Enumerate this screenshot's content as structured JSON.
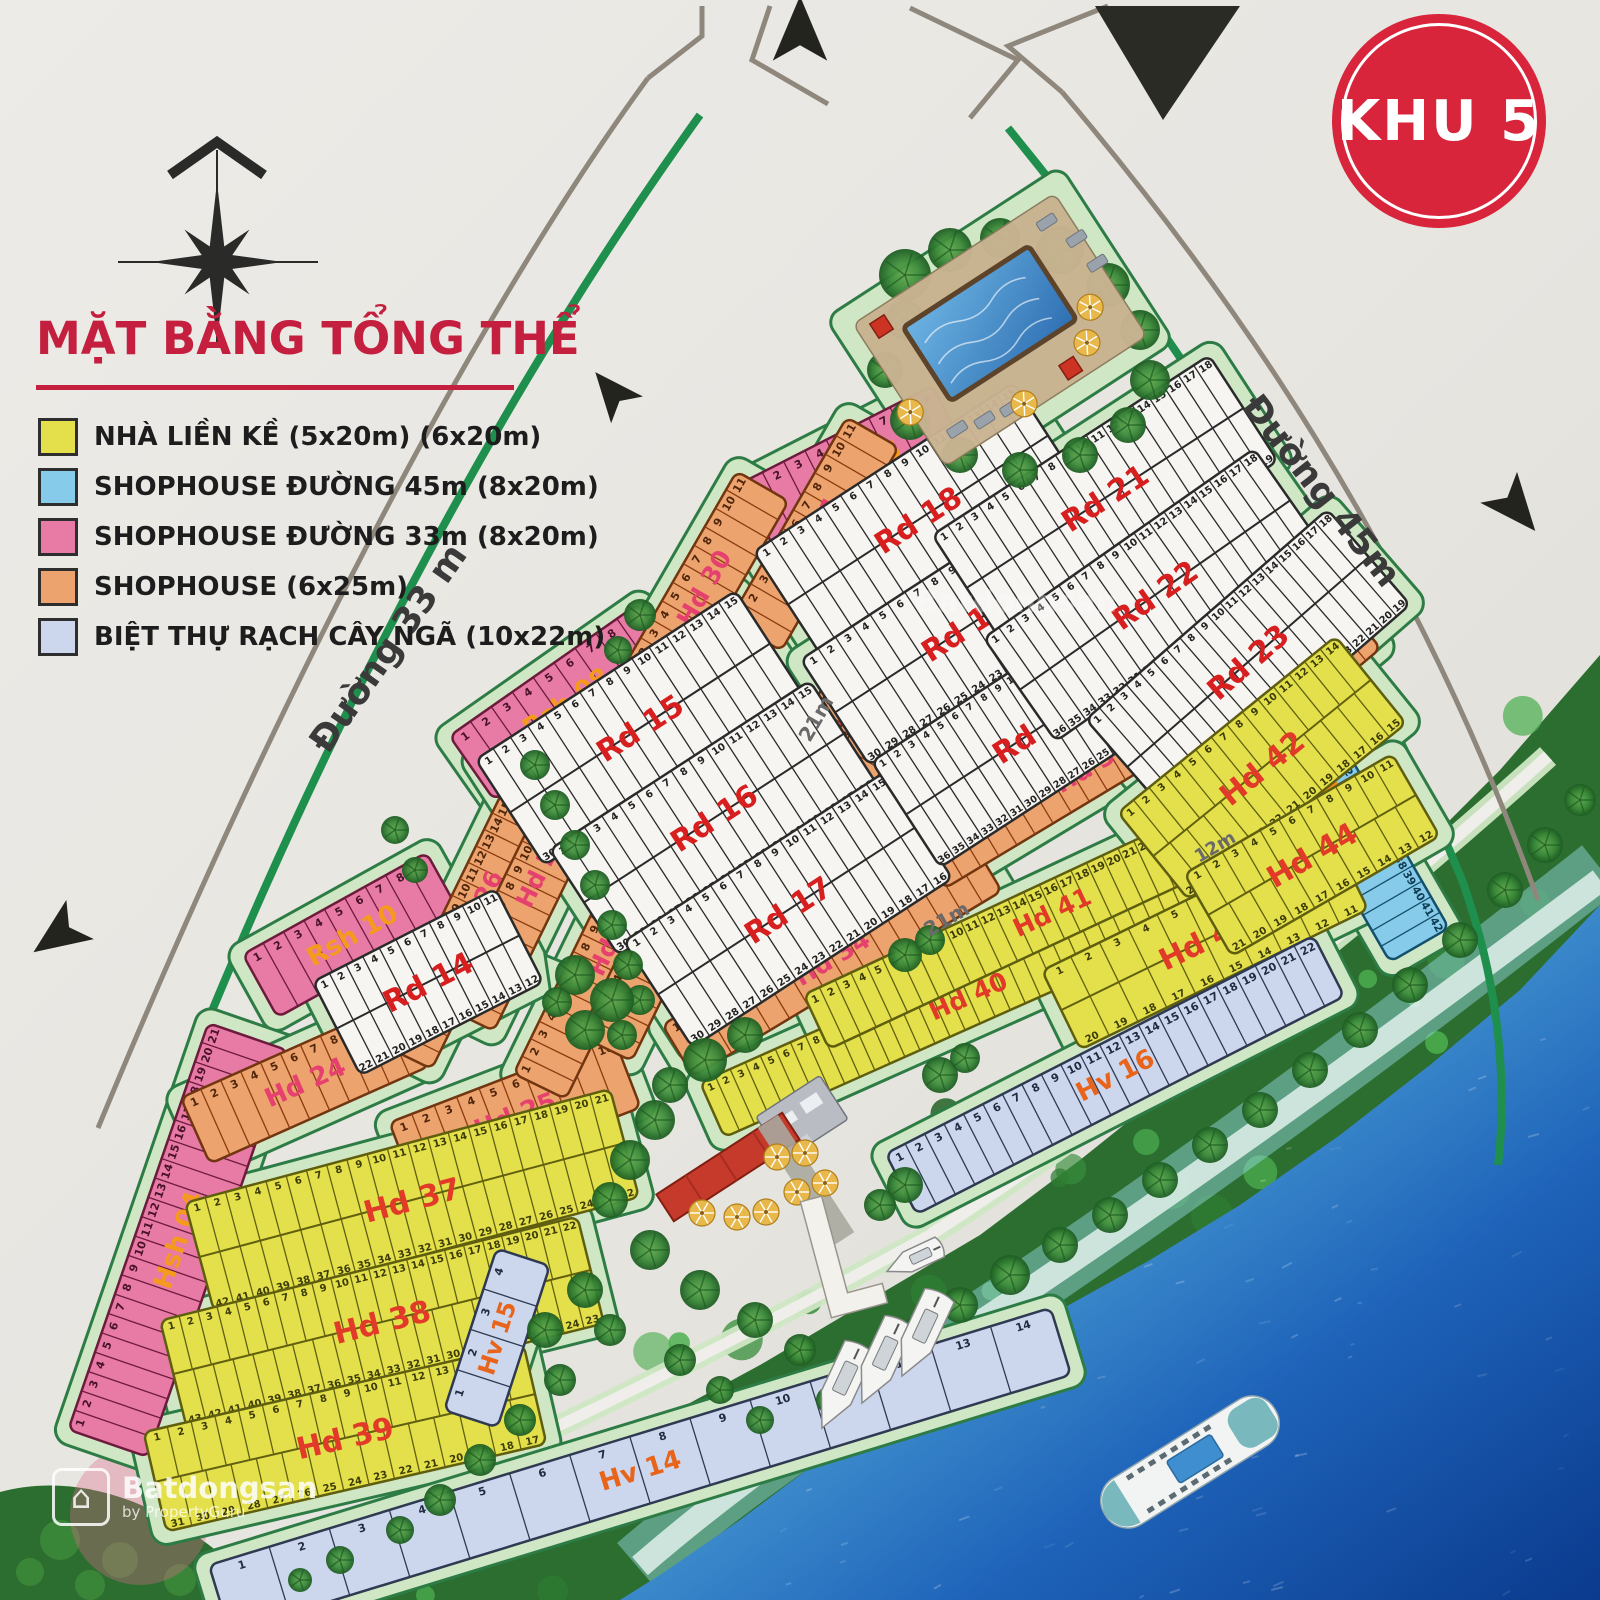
{
  "badge": {
    "text": "KHU 5",
    "bg": "#d8253c",
    "fg": "#ffffff"
  },
  "legend": {
    "title": "MẶT BẰNG TỔNG THỂ",
    "title_color": "#c41f3e",
    "items": [
      {
        "label": "NHÀ LIỀN KỀ (5x20m) (6x20m)",
        "color": "#e3e04b"
      },
      {
        "label": "SHOPHOUSE  ĐƯỜNG 45m (8x20m)",
        "color": "#86cbe9"
      },
      {
        "label": "SHOPHOUSE  ĐƯỜNG 33m (8x20m)",
        "color": "#e77ba6"
      },
      {
        "label": "SHOPHOUSE (6x25m)",
        "color": "#eca36e"
      },
      {
        "label": "BIỆT THỰ RẠCH CÂY NGÃ (10x22m)",
        "color": "#ccd7ee"
      }
    ]
  },
  "watermark": {
    "line1": "Batdongsan",
    "line2": "by PropertyGuru",
    "brand": "Batdongsan"
  },
  "road_labels": [
    {
      "text": "Đường 33 m",
      "x": 398,
      "y": 655,
      "rot": -55,
      "size": 36,
      "color": "#3a3a3a"
    },
    {
      "text": "Đường 45m",
      "x": 1312,
      "y": 498,
      "rot": 52,
      "size": 36,
      "color": "#3a3a3a"
    },
    {
      "text": "21m",
      "x": 822,
      "y": 722,
      "rot": -60,
      "size": 20,
      "color": "#6a6a6a"
    },
    {
      "text": "21m",
      "x": 950,
      "y": 925,
      "rot": -30,
      "size": 20,
      "color": "#6a6a6a"
    },
    {
      "text": "12m",
      "x": 1218,
      "y": 852,
      "rot": -30,
      "size": 18,
      "color": "#6a6a6a"
    }
  ],
  "block_label_colors": {
    "pink": "#f59a1d",
    "orange": "#e5406e",
    "yellow": "#e23a28",
    "blue": "#f08a1d",
    "villa": "#e8641a",
    "white": "#d81f1f"
  },
  "blocks": [
    {
      "label": "Rsh 06",
      "type": "pink",
      "x": 855,
      "y": 470,
      "w": 215,
      "h": 80,
      "a": -27,
      "rows": 1,
      "from": 1,
      "to": 9
    },
    {
      "label": "Rsh 08",
      "type": "pink",
      "x": 566,
      "y": 702,
      "w": 230,
      "h": 78,
      "a": -35,
      "rows": 1,
      "from": 1,
      "to": 9
    },
    {
      "label": "Rsh 10",
      "type": "pink",
      "x": 352,
      "y": 935,
      "w": 210,
      "h": 72,
      "a": -29,
      "rows": 1,
      "from": 1,
      "to": 9
    },
    {
      "label": "Hsh 04",
      "type": "pink",
      "x": 178,
      "y": 1240,
      "w": 430,
      "h": 84,
      "a": -71,
      "rows": 1,
      "from": 1,
      "to": 21
    },
    {
      "label": "Rsh 16",
      "type": "blue",
      "x": 1252,
      "y": 565,
      "w": 350,
      "h": 78,
      "a": 63,
      "rows": 1,
      "from": 1,
      "to": 16
    },
    {
      "label": "Hsh 05",
      "type": "blue",
      "x": 1352,
      "y": 828,
      "w": 270,
      "h": 68,
      "a": 60,
      "rows": 1,
      "from": 28,
      "to": 42
    },
    {
      "label": "Hd 24",
      "type": "orange",
      "x": 305,
      "y": 1082,
      "w": 240,
      "h": 72,
      "a": -24,
      "rows": 1,
      "from": 1,
      "to": 11
    },
    {
      "label": "Hd 25",
      "type": "orange",
      "x": 515,
      "y": 1115,
      "w": 240,
      "h": 76,
      "a": -21,
      "rows": 1,
      "from": 1,
      "to": 10
    },
    {
      "label": "Hd 26",
      "type": "orange",
      "x": 478,
      "y": 908,
      "w": 330,
      "h": 58,
      "a": -64,
      "rows": 1,
      "from": 1,
      "to": 18
    },
    {
      "label": "Hd 27",
      "type": "orange",
      "x": 540,
      "y": 870,
      "w": 330,
      "h": 58,
      "a": -64,
      "rows": 1,
      "from": 1,
      "to": 18
    },
    {
      "label": "Hd 28",
      "type": "orange",
      "x": 612,
      "y": 938,
      "w": 330,
      "h": 58,
      "a": -64,
      "rows": 1,
      "from": 1,
      "to": 17
    },
    {
      "label": "Hd 29",
      "type": "orange",
      "x": 678,
      "y": 900,
      "w": 330,
      "h": 58,
      "a": -64,
      "rows": 1,
      "from": 1,
      "to": 17
    },
    {
      "label": "Hd 30",
      "type": "orange",
      "x": 704,
      "y": 588,
      "w": 235,
      "h": 60,
      "a": -60,
      "rows": 1,
      "from": 1,
      "to": 11
    },
    {
      "label": "Hd 31",
      "type": "orange",
      "x": 814,
      "y": 534,
      "w": 235,
      "h": 60,
      "a": -60,
      "rows": 1,
      "from": 1,
      "to": 11
    },
    {
      "label": "Hd 32",
      "type": "orange",
      "x": 848,
      "y": 702,
      "w": 300,
      "h": 58,
      "a": -58,
      "rows": 1,
      "from": 1,
      "to": 14
    },
    {
      "label": "Hd 33",
      "type": "orange",
      "x": 914,
      "y": 664,
      "w": 300,
      "h": 58,
      "a": -58,
      "rows": 1,
      "from": 1,
      "to": 14
    },
    {
      "label": "Hd 34",
      "type": "orange",
      "x": 832,
      "y": 958,
      "w": 360,
      "h": 60,
      "a": -31,
      "rows": 1,
      "from": 1,
      "to": 16
    },
    {
      "label": "Hd 35",
      "type": "orange",
      "x": 1092,
      "y": 765,
      "w": 380,
      "h": 60,
      "a": -31,
      "rows": 1,
      "from": 1,
      "to": 18
    },
    {
      "label": "Hd 36",
      "type": "orange",
      "x": 1258,
      "y": 712,
      "w": 270,
      "h": 60,
      "a": -40,
      "rows": 1,
      "from": 1,
      "to": 14
    },
    {
      "label": "Rd 14",
      "type": "white",
      "x": 428,
      "y": 982,
      "w": 205,
      "h": 105,
      "a": -27,
      "rows": 2,
      "from": 1,
      "to": 22
    },
    {
      "label": "Rd 15",
      "type": "white",
      "x": 640,
      "y": 728,
      "w": 310,
      "h": 126,
      "a": -33,
      "rows": 2,
      "from": 1,
      "to": 30
    },
    {
      "label": "Rd 16",
      "type": "white",
      "x": 714,
      "y": 818,
      "w": 310,
      "h": 126,
      "a": -33,
      "rows": 2,
      "from": 1,
      "to": 30
    },
    {
      "label": "Rd 17",
      "type": "white",
      "x": 788,
      "y": 910,
      "w": 310,
      "h": 126,
      "a": -33,
      "rows": 2,
      "from": 1,
      "to": 30
    },
    {
      "label": "Rd 18",
      "type": "white",
      "x": 918,
      "y": 520,
      "w": 310,
      "h": 126,
      "a": -33,
      "rows": 2,
      "from": 1,
      "to": 30
    },
    {
      "label": "Rd 19",
      "type": "white",
      "x": 965,
      "y": 628,
      "w": 310,
      "h": 126,
      "a": -33,
      "rows": 2,
      "from": 1,
      "to": 30
    },
    {
      "label": "Rd 20",
      "type": "white",
      "x": 1036,
      "y": 730,
      "w": 310,
      "h": 126,
      "a": -33,
      "rows": 2,
      "from": 1,
      "to": 36
    },
    {
      "label": "Rd 21",
      "type": "white",
      "x": 1105,
      "y": 498,
      "w": 330,
      "h": 126,
      "a": -33,
      "rows": 2,
      "from": 1,
      "to": 36
    },
    {
      "label": "Rd 22",
      "type": "white",
      "x": 1155,
      "y": 595,
      "w": 330,
      "h": 126,
      "a": -35,
      "rows": 2,
      "from": 1,
      "to": 36
    },
    {
      "label": "Rd 23",
      "type": "white",
      "x": 1248,
      "y": 662,
      "w": 320,
      "h": 126,
      "a": -41,
      "rows": 2,
      "from": 1,
      "to": 36
    },
    {
      "label": "Hd 37",
      "type": "yellow",
      "x": 412,
      "y": 1200,
      "w": 440,
      "h": 112,
      "a": -15,
      "rows": 2,
      "from": 1,
      "to": 42
    },
    {
      "label": "Hd 38",
      "type": "yellow",
      "x": 382,
      "y": 1322,
      "w": 430,
      "h": 110,
      "a": -14,
      "rows": 2,
      "from": 1,
      "to": 43
    },
    {
      "label": "Hd 39",
      "type": "yellow",
      "x": 345,
      "y": 1438,
      "w": 390,
      "h": 102,
      "a": -13,
      "rows": 2,
      "from": 1,
      "to": 31
    },
    {
      "label": "Hd 40",
      "type": "yellow",
      "x": 968,
      "y": 996,
      "w": 560,
      "h": 60,
      "a": -24,
      "rows": 1,
      "from": 1,
      "to": 34
    },
    {
      "label": "Hd 41",
      "type": "yellow",
      "x": 1052,
      "y": 912,
      "w": 520,
      "h": 60,
      "a": -25,
      "rows": 1,
      "from": 1,
      "to": 30
    },
    {
      "label": "Hd 42",
      "type": "yellow",
      "x": 1262,
      "y": 768,
      "w": 280,
      "h": 112,
      "a": -39,
      "rows": 2,
      "from": 1,
      "to": 27
    },
    {
      "label": "Hd 43",
      "type": "yellow",
      "x": 1205,
      "y": 940,
      "w": 320,
      "h": 88,
      "a": -26,
      "rows": 2,
      "from": 1,
      "to": 20
    },
    {
      "label": "Hd 44",
      "type": "yellow",
      "x": 1312,
      "y": 855,
      "w": 240,
      "h": 95,
      "a": -30,
      "rows": 2,
      "from": 1,
      "to": 21
    },
    {
      "label": "Hv 14",
      "type": "villa",
      "x": 640,
      "y": 1470,
      "w": 880,
      "h": 70,
      "a": -17,
      "rows": 1,
      "from": 1,
      "to": 14
    },
    {
      "label": "Hv 15",
      "type": "villa",
      "x": 497,
      "y": 1338,
      "w": 170,
      "h": 56,
      "a": -72,
      "rows": 1,
      "from": 1,
      "to": 4
    },
    {
      "label": "Hv 16",
      "type": "villa",
      "x": 1115,
      "y": 1075,
      "w": 480,
      "h": 68,
      "a": -27,
      "rows": 1,
      "from": 1,
      "to": 22
    }
  ]
}
